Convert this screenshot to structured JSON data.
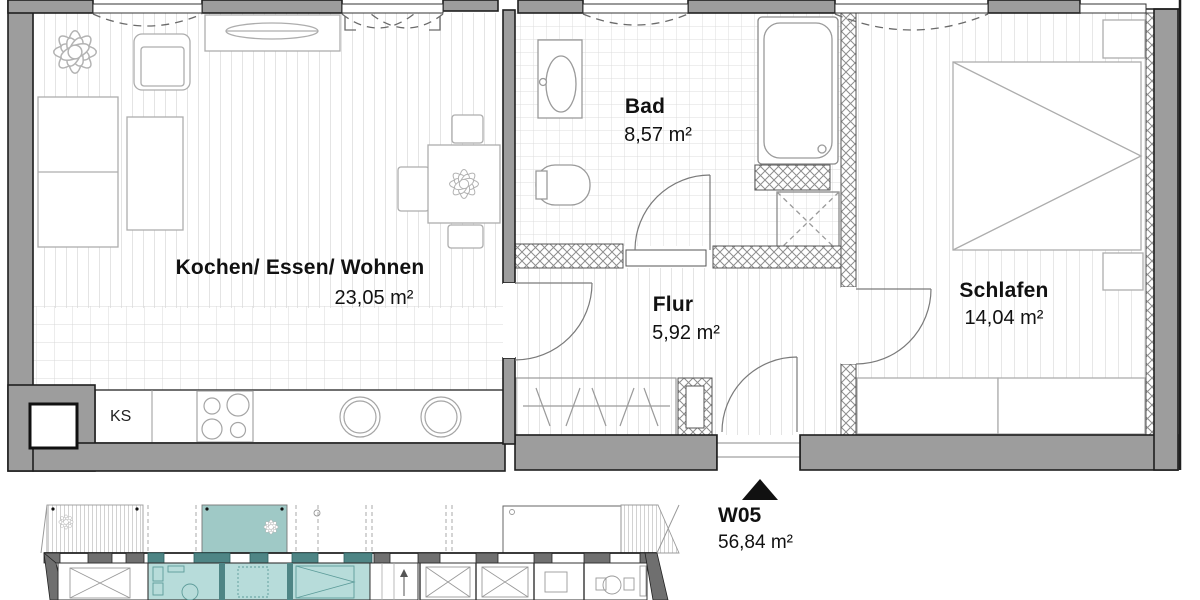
{
  "plan": {
    "rooms": [
      {
        "name": "Kochen/ Essen/ Wohnen",
        "area": "23,05 m²"
      },
      {
        "name": "Bad",
        "area": "8,57 m²"
      },
      {
        "name": "Flur",
        "area": "5,92 m²"
      },
      {
        "name": "Schlafen",
        "area": "14,04 m²"
      }
    ],
    "unit": {
      "code": "W05",
      "area": "56,84 m²"
    },
    "labels": {
      "fridge": "KS"
    },
    "colors": {
      "wall_gray": "#9d9d9d",
      "outline": "#1f1f1f",
      "unit_highlight_fill": "#b7dcda",
      "unit_highlight_wall": "#4e8585",
      "balcony_highlight": "#9fc9c6"
    }
  }
}
